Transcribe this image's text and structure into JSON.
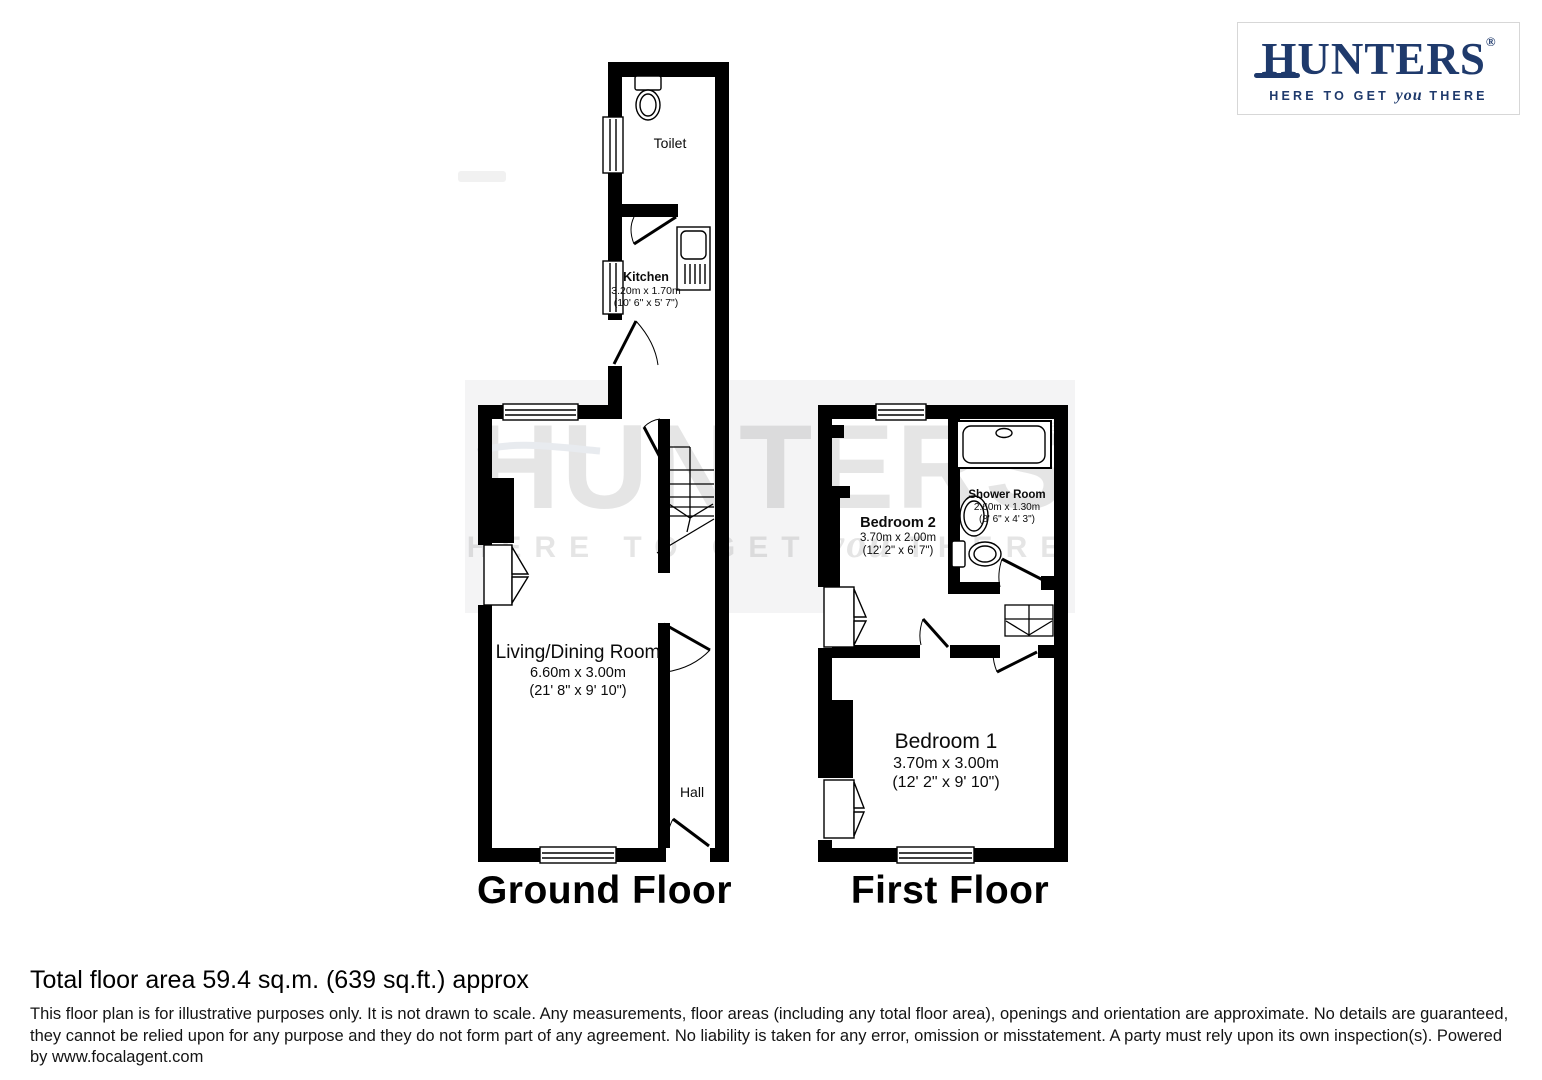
{
  "logo": {
    "text": "HUNTERS",
    "reg": "®",
    "tagline_pre": "HERE TO GET",
    "tagline_you": "you",
    "tagline_post": "THERE"
  },
  "watermark": {
    "text": "HUNTERS",
    "reg": "®",
    "tagline_pre": "HERE TO GET",
    "tagline_you": "you",
    "tagline_post": "THERE"
  },
  "floors": {
    "ground": {
      "label": "Ground Floor"
    },
    "first": {
      "label": "First Floor"
    }
  },
  "rooms": {
    "toilet": {
      "name": "Toilet"
    },
    "kitchen": {
      "name": "Kitchen",
      "dims_m": "3.20m x 1.70m",
      "dims_ft": "(10' 6\" x 5' 7\")"
    },
    "living": {
      "name": "Living/Dining Room",
      "dims_m": "6.60m x 3.00m",
      "dims_ft": "(21' 8\" x 9' 10\")"
    },
    "hall": {
      "name": "Hall"
    },
    "bedroom2": {
      "name": "Bedroom 2",
      "dims_m": "3.70m x 2.00m",
      "dims_ft": "(12' 2\" x 6' 7\")"
    },
    "shower": {
      "name": "Shower Room",
      "dims_m": "2.60m x 1.30m",
      "dims_ft": "(8' 6\" x 4' 3\")"
    },
    "bedroom1": {
      "name": "Bedroom 1",
      "dims_m": "3.70m x 3.00m",
      "dims_ft": "(12' 2\" x 9' 10\")"
    }
  },
  "footer": {
    "total_area": "Total floor area 59.4 sq.m. (639 sq.ft.) approx",
    "disclaimer": [
      "This floor plan is for illustrative purposes only. It is not drawn to scale. Any measurements, floor areas (including any total floor area), openings and orientation are approximate. No details are guaranteed,",
      "they cannot be relied upon for any purpose and they do not form part of any agreement. No liability is taken for any error, omission or misstatement. A party must rely upon its own inspection(s). Powered",
      "by www.focalagent.com"
    ]
  },
  "colors": {
    "wall": "#000000",
    "brand": "#1f3a6c",
    "watermark_band": "#f4f4f5",
    "watermark_text": "#2b4470"
  }
}
